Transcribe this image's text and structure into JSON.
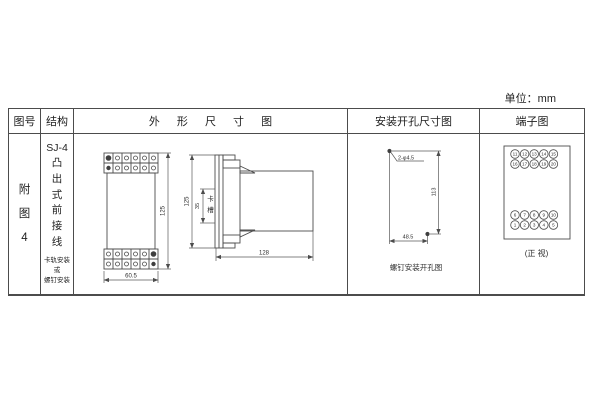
{
  "unit_label": "单位：mm",
  "colors": {
    "line": "#4c4c4c",
    "text": "#2f2f2f",
    "background": "#ffffff"
  },
  "table": {
    "headers": [
      "图号",
      "结构",
      "外 形 尺 寸 图",
      "安装开孔尺寸图",
      "端子图"
    ]
  },
  "row": {
    "figure_no": "附图4",
    "structure": {
      "model": "SJ-4",
      "type": "凸出式前接线",
      "mounting": "卡轨安装\n或\n螺钉安装"
    }
  },
  "outline": {
    "front_width": "60.5",
    "front_height": "125",
    "side_height": "125",
    "slot_dim": "35",
    "slot_label": "卡槽",
    "side_depth": "128"
  },
  "install": {
    "holes_label": "2-φ4.5",
    "vertical_dim": "113",
    "horizontal_dim": "48.5",
    "caption": "螺钉安装开孔图"
  },
  "terminal": {
    "top_rows": [
      [
        "11",
        "12",
        "13",
        "14",
        "15"
      ],
      [
        "16",
        "17",
        "18",
        "19",
        "20"
      ]
    ],
    "bottom_rows": [
      [
        "6",
        "7",
        "8",
        "9",
        "10"
      ],
      [
        "1",
        "2",
        "3",
        "4",
        "5"
      ]
    ],
    "caption": "(正 视)"
  }
}
